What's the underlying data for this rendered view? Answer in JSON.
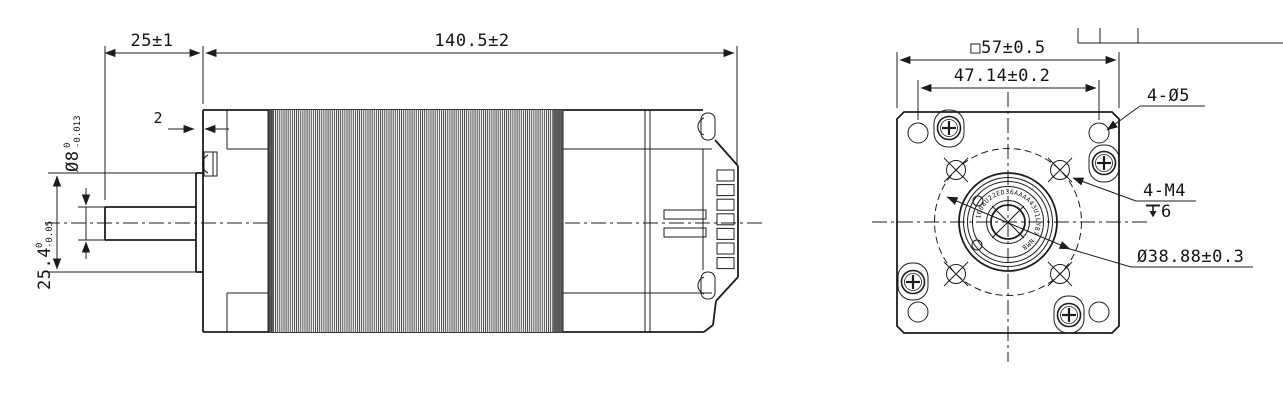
{
  "drawing": {
    "side_view": {
      "shaft_length": "25±1",
      "body_length": "140.5±2",
      "boss_thickness": "2",
      "shaft_diameter": {
        "nominal": "Ø8",
        "tol_upper": "0",
        "tol_lower": "-0.013"
      },
      "pilot_diameter": {
        "nominal": "25.4",
        "tol_upper": "0",
        "tol_lower": "-0.05"
      }
    },
    "front_view": {
      "frame_size": "□57±0.5",
      "mounting_hole_spacing": "47.14±0.2",
      "corner_holes_callout": "4-Ø5",
      "mounting_thread_callout": "4-M4",
      "thread_depth_value": "6",
      "bolt_circle_diameter": "Ø38.88±0.3",
      "hub_ring_label": "1608U22ED36AAAA43U1LYB7 NMB"
    },
    "colors": {
      "line": "#1c1c1c",
      "background": "#ffffff",
      "stator_hatch": "#3c3c3c"
    }
  }
}
